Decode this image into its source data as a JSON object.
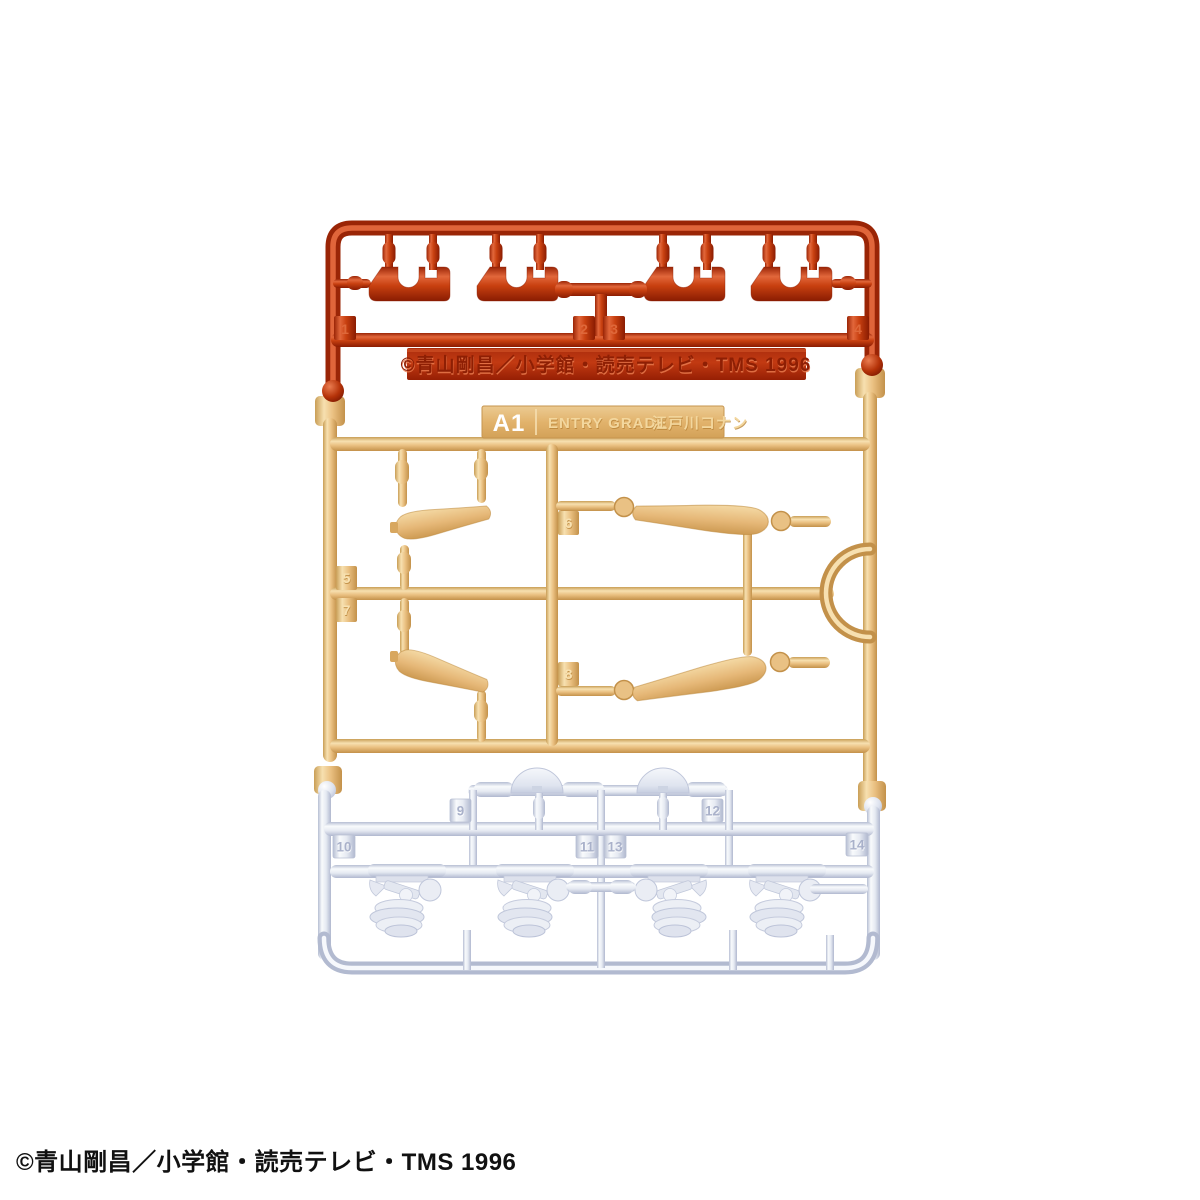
{
  "photo": {
    "subject": "plastic model kit runner A1"
  },
  "label": {
    "code": "A1",
    "series": "ENTRY GRADE",
    "character": "江戸川コナン"
  },
  "molded_copyright": "©青山剛昌／小学館・読売テレビ・TMS 1996",
  "footer_copyright": "©青山剛昌／小学館・読売テレビ・TMS 1996",
  "tags": {
    "t1": "1",
    "t2": "2",
    "t3": "3",
    "t4": "4",
    "t5": "5",
    "t6": "6",
    "t7": "7",
    "t8": "8",
    "t9": "9",
    "t10": "10",
    "t11": "11",
    "t12": "12",
    "t13": "13",
    "t14": "14"
  },
  "colors": {
    "red": "#c84010",
    "tan": "#eac081",
    "white_gray": "#e6eaf2",
    "background": "#ffffff"
  }
}
